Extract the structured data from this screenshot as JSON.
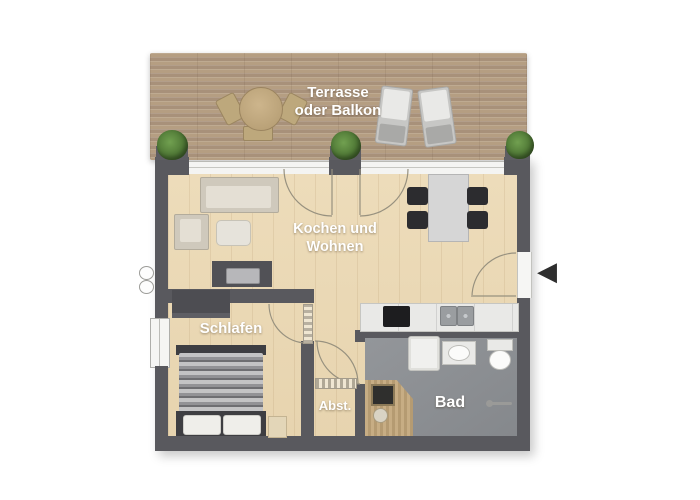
{
  "rooms": {
    "terrace": {
      "line1": "Terrasse",
      "line2": "oder Balkon"
    },
    "living": {
      "line1": "Kochen und",
      "line2": "Wohnen"
    },
    "bedroom": {
      "label": "Schlafen"
    },
    "storage": {
      "label": "Abst."
    },
    "bath": {
      "label": "Bad"
    }
  },
  "icons": {
    "entry_arrow": "◀"
  },
  "colors": {
    "wall": "#59595e",
    "wood_floor": "#eddcba",
    "deck_wood": "#b09879",
    "bath_floor": "#8d9094",
    "label_text": "#ffffff",
    "plant_green": "#4c7433",
    "furniture_dark": "#3e3e42"
  }
}
